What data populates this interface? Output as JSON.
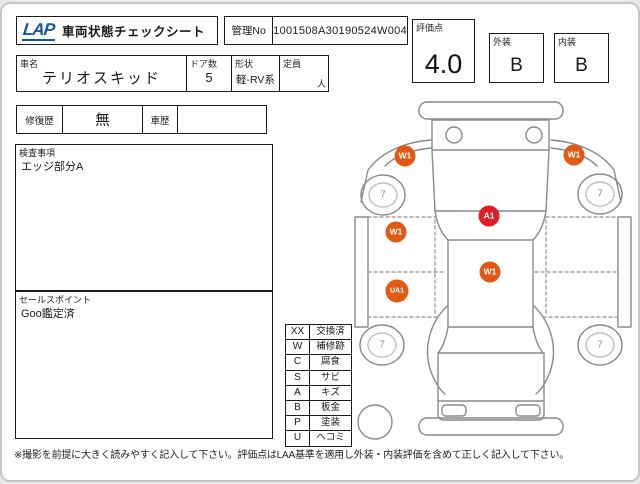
{
  "header": {
    "logo": "LAP",
    "title": "車両状態チェックシート",
    "kanri_label": "管理No",
    "kanri_value": "1001508A30190524W004",
    "score_label": "評価点",
    "score_value": "4.0",
    "exterior_label": "外装",
    "exterior_value": "B",
    "interior_label": "内装",
    "interior_value": "B"
  },
  "vehicle": {
    "name_label": "車名",
    "name_value": "テリオスキッド",
    "doors_label": "ドア数",
    "doors_value": "5",
    "shape_label": "形状",
    "shape_value": "軽-RV系",
    "capacity_label": "定員",
    "capacity_value": "",
    "capacity_unit": "人"
  },
  "history": {
    "repair_label": "修復歴",
    "repair_value": "無",
    "car_history_label": "車歴",
    "car_history_value": ""
  },
  "inspection": {
    "label": "検査事項",
    "value": "エッジ部分A"
  },
  "sales": {
    "label": "セールスポイント",
    "value": "Goo鑑定済"
  },
  "legend": {
    "rows": [
      {
        "code": "XX",
        "meaning": "交換済"
      },
      {
        "code": "W",
        "meaning": "補修跡"
      },
      {
        "code": "C",
        "meaning": "腐食"
      },
      {
        "code": "S",
        "meaning": "サビ"
      },
      {
        "code": "A",
        "meaning": "キズ"
      },
      {
        "code": "B",
        "meaning": "板金"
      },
      {
        "code": "P",
        "meaning": "塗装"
      },
      {
        "code": "U",
        "meaning": "ヘコミ"
      }
    ]
  },
  "diagram": {
    "colors": {
      "repair": "#e25913",
      "scratch": "#dd1f26",
      "outline": "#8a8a8a",
      "wheel_text": "#949494"
    },
    "markers": [
      {
        "label": "W1",
        "x": 58,
        "y": 62,
        "type": "repair"
      },
      {
        "label": "W1",
        "x": 227,
        "y": 61,
        "type": "repair"
      },
      {
        "label": "A1",
        "x": 142,
        "y": 122,
        "type": "scratch"
      },
      {
        "label": "W1",
        "x": 49,
        "y": 138,
        "type": "repair"
      },
      {
        "label": "W1",
        "x": 143,
        "y": 178,
        "type": "repair"
      },
      {
        "label": "UA1",
        "x": 50,
        "y": 197,
        "type": "repair"
      }
    ],
    "wheels": [
      {
        "label": "7",
        "x": 36,
        "y": 101
      },
      {
        "label": "7",
        "x": 253,
        "y": 100
      },
      {
        "label": "7",
        "x": 35,
        "y": 251
      },
      {
        "label": "7",
        "x": 253,
        "y": 251
      }
    ]
  },
  "footer": {
    "note": "※撮影を前提に大きく読みやすく記入して下さい。評価点はLAA基準を適用し外装・内装評価を含めて正しく記入して下さい。"
  }
}
